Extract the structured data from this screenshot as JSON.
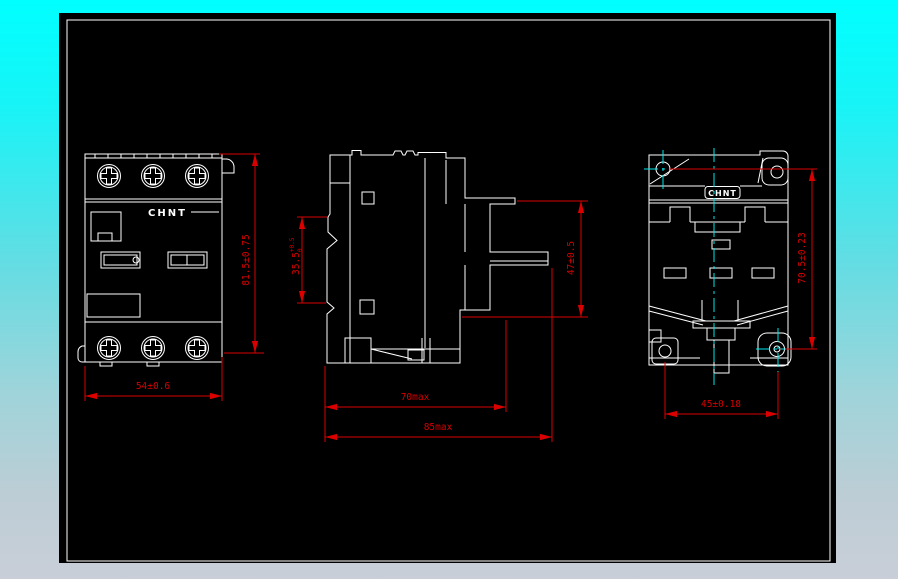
{
  "drawing": {
    "brand_logo": "CHNT",
    "colors": {
      "canvas_background": "#000000",
      "outline_lines": "#ffffff",
      "dimension_lines": "#da0000",
      "centerlines": "#00e9e9",
      "border_top": "#00ffff",
      "border_bottom": "#c9ced8"
    },
    "front_view": {
      "logo": "CHNT",
      "dim_height": "81.5±0.75",
      "dim_width": "54±0.6"
    },
    "side_view": {
      "dim_rail": "35.5",
      "dim_rail_tol_upper": "+0.5",
      "dim_rail_tol_lower": "0",
      "dim_terminal_height": "47±0.5",
      "dim_depth_body": "70max",
      "dim_depth_total": "85max"
    },
    "back_view": {
      "logo": "CHNT",
      "dim_mounting_vertical": "70.5±0.23",
      "dim_mounting_horizontal": "45±0.18"
    }
  }
}
